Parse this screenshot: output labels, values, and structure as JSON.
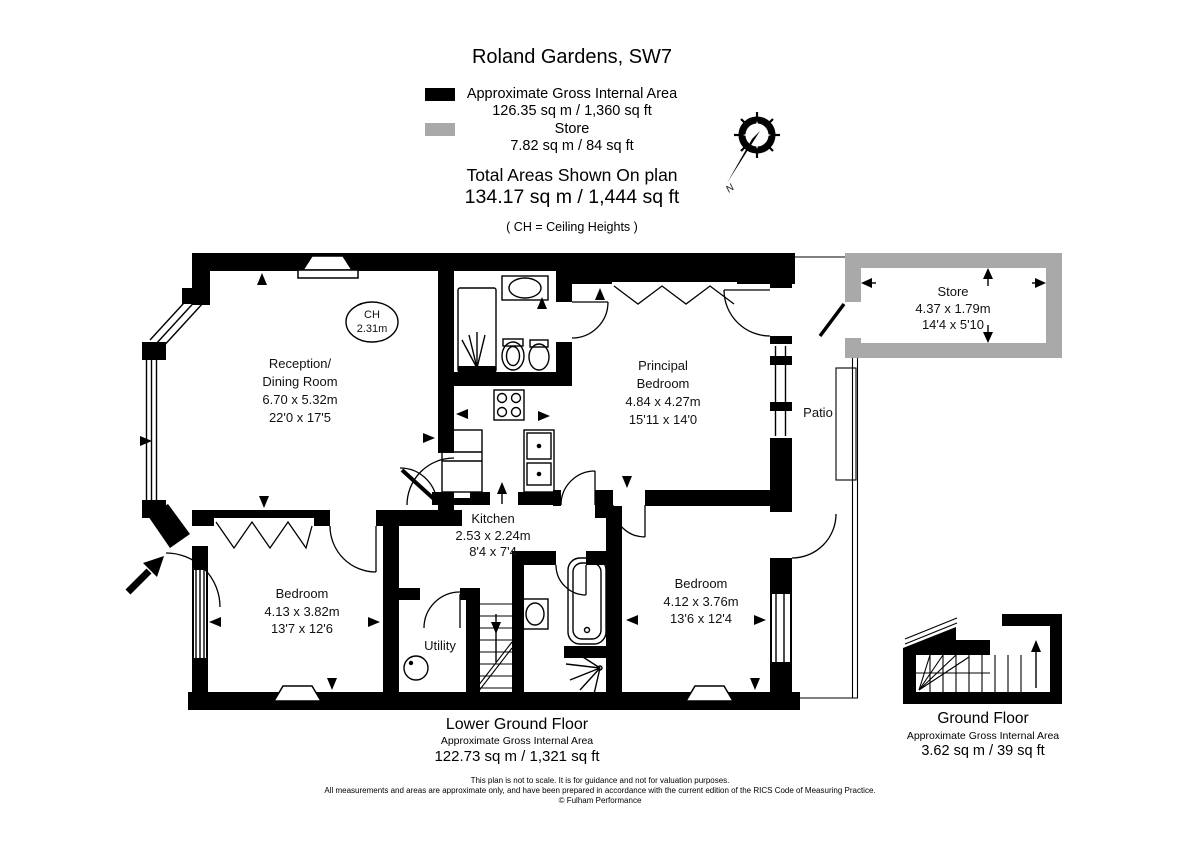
{
  "title": "Roland Gardens, SW7",
  "legend": {
    "gia_label": "Approximate Gross Internal Area",
    "gia_value": "126.35 sq m / 1,360 sq ft",
    "store_label": "Store",
    "store_value": "7.82 sq m / 84 sq ft",
    "total_label": "Total Areas Shown On plan",
    "total_value": "134.17 sq m / 1,444 sq ft",
    "ch_note": "( CH = Ceiling Heights )"
  },
  "compass": {
    "north": "N"
  },
  "rooms": {
    "reception": {
      "name1": "Reception/",
      "name2": "Dining Room",
      "metric": "6.70 x 5.32m",
      "imperial": "22'0 x 17'5"
    },
    "ch_badge": {
      "line1": "CH",
      "line2": "2.31m"
    },
    "principal": {
      "name1": "Principal",
      "name2": "Bedroom",
      "metric": "4.84 x 4.27m",
      "imperial": "15'11 x 14'0"
    },
    "store": {
      "name": "Store",
      "metric": "4.37 x 1.79m",
      "imperial": "14'4 x 5'10"
    },
    "kitchen": {
      "name": "Kitchen",
      "metric": "2.53 x 2.24m",
      "imperial": "8'4 x 7'4"
    },
    "bedroom_left": {
      "name": "Bedroom",
      "metric": "4.13 x 3.82m",
      "imperial": "13'7 x 12'6"
    },
    "bedroom_right": {
      "name": "Bedroom",
      "metric": "4.12 x 3.76m",
      "imperial": "13'6 x 12'4"
    },
    "utility": {
      "name": "Utility"
    },
    "patio": {
      "name": "Patio"
    }
  },
  "floors": {
    "lower": {
      "name": "Lower Ground Floor",
      "sub": "Approximate Gross Internal Area",
      "area": "122.73 sq m / 1,321 sq ft"
    },
    "ground": {
      "name": "Ground Floor",
      "sub": "Approximate Gross Internal Area",
      "area": "3.62 sq m / 39 sq ft"
    }
  },
  "disclaimer": {
    "line1": "This plan is not to scale. It is for guidance and not for valuation purposes.",
    "line2": "All measurements and areas are approximate only, and have been prepared in accordance with the current edition of the RICS Code of Measuring Practice.",
    "line3": "© Fulham Performance"
  },
  "colors": {
    "wall": "#000000",
    "store_wall": "#a9a9a9"
  }
}
